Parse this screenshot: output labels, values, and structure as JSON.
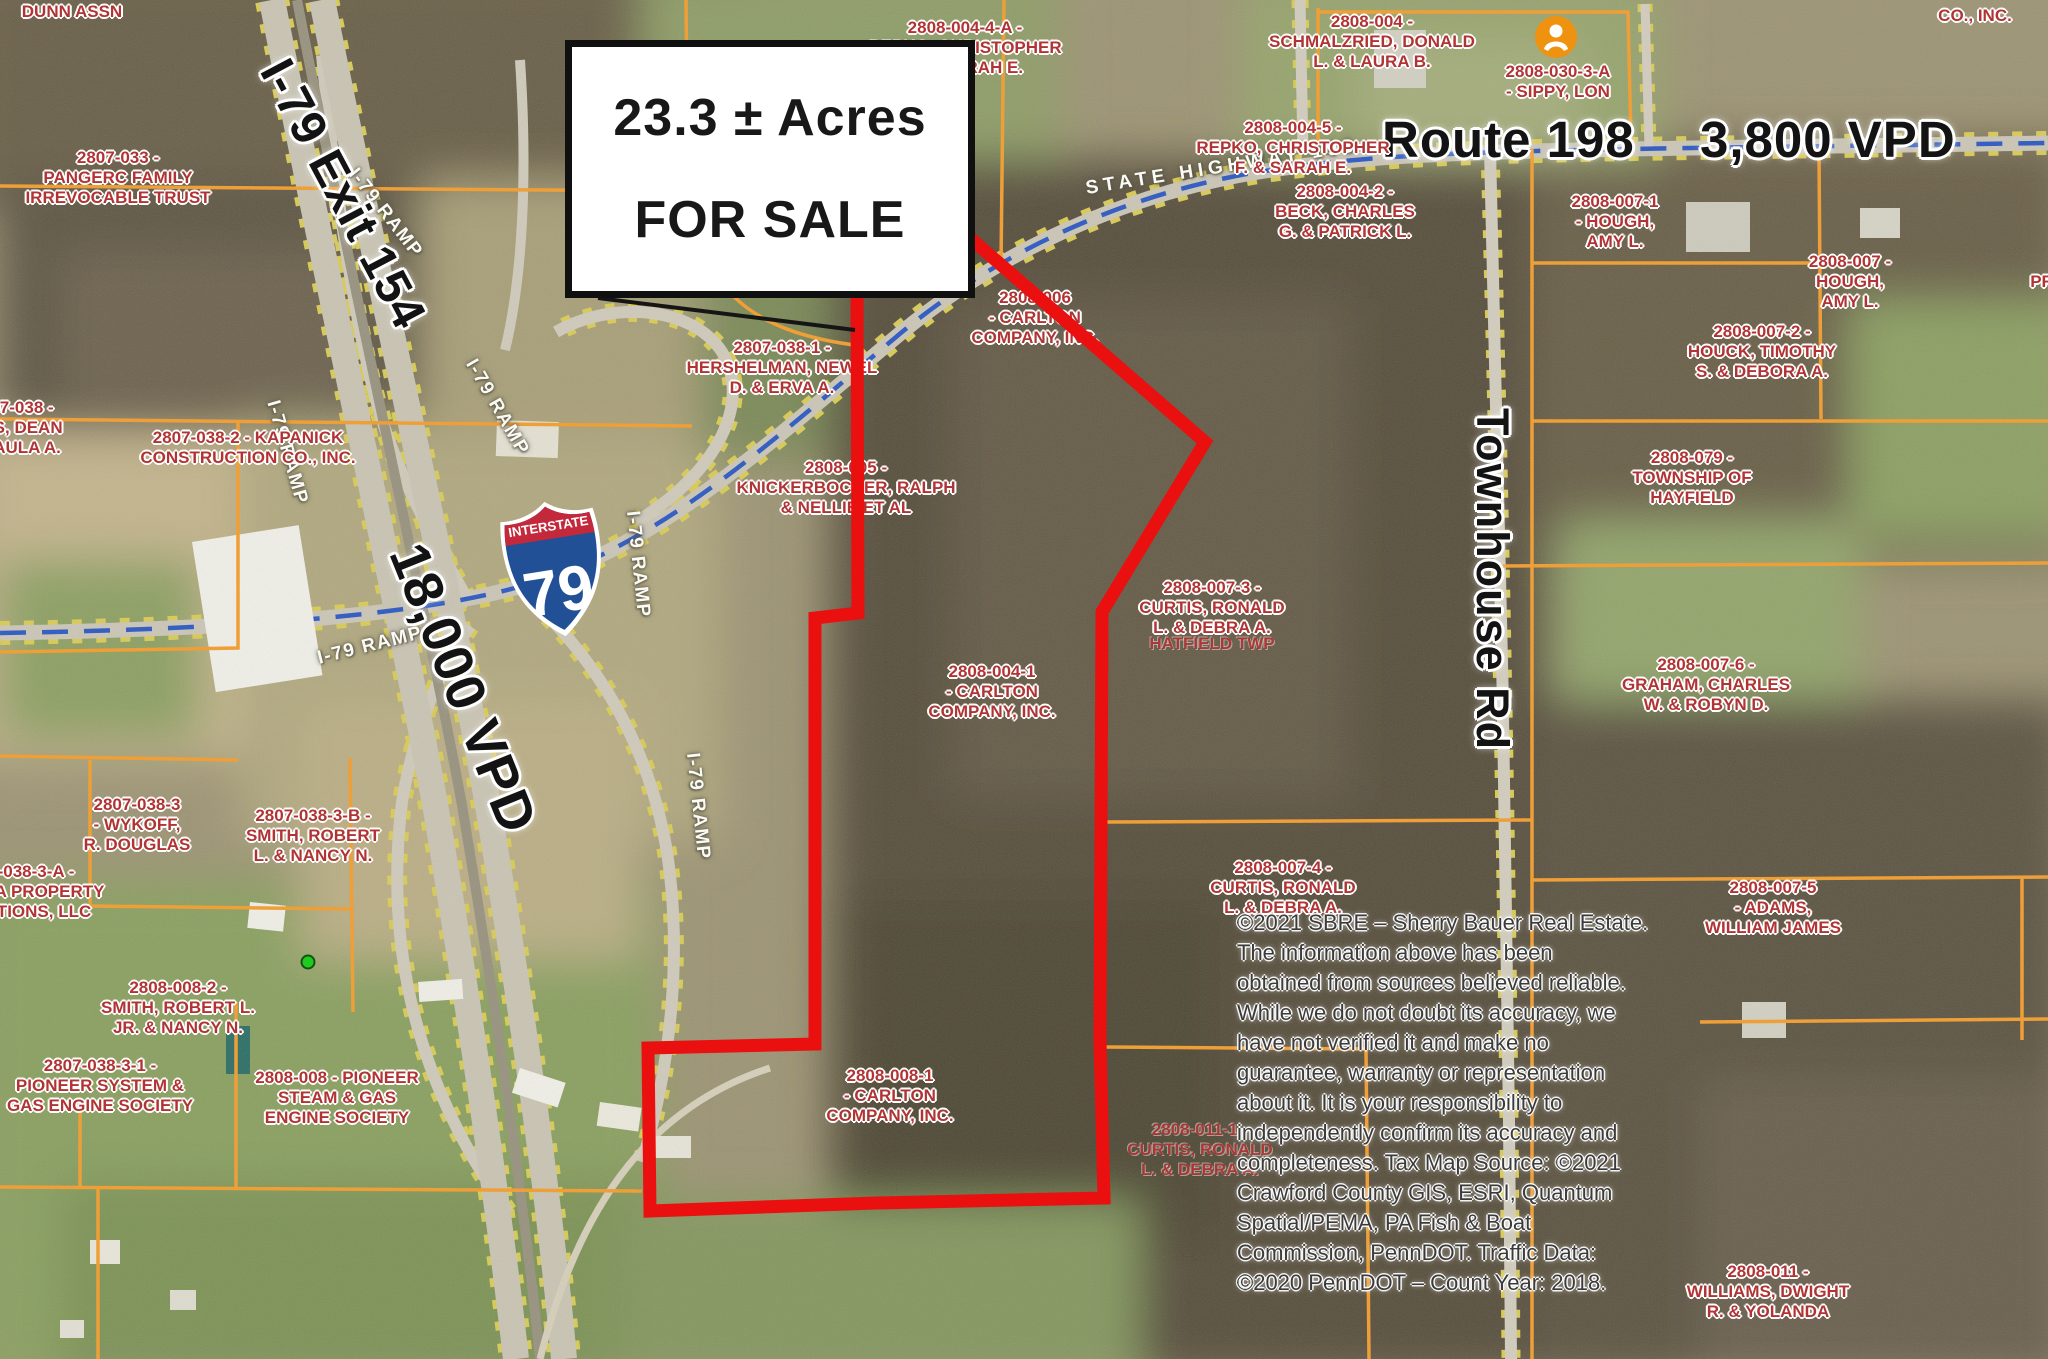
{
  "map_title": "Aerial tax-parcel map of 23.3 acre property at I-79 Exit 154 and Route 198",
  "sale_box": {
    "line1": "23.3 ± Acres",
    "line2": "FOR SALE"
  },
  "big_labels": {
    "i79_exit": "I-79  Exit 154",
    "i79_vpd": "18,000 VPD",
    "route": "Route 198",
    "route_vpd": "3,800 VPD",
    "townhouse_rd": "Townhouse Rd"
  },
  "shield": {
    "top": "INTERSTATE",
    "number": "79"
  },
  "colors": {
    "property_outline_red": "#ea1010",
    "parcel_line_orange": "#ef9f38",
    "parcel_label_red": "#b13434",
    "state_route_blue": "#2b59c3",
    "road_edge_yellow": "#d9cb55",
    "shield_blue": "#215097",
    "shield_red": "#c3293b",
    "poi_marker_orange": "#ef9210",
    "site_dot_green": "#1ecb1e"
  },
  "road_labels": [
    {
      "text": "I-79 RAMP",
      "x": 352,
      "y": 160,
      "rot": 52
    },
    {
      "text": "I-79 RAMP",
      "x": 272,
      "y": 390,
      "rot": 74
    },
    {
      "text": "I-79 RAMP",
      "x": 470,
      "y": 350,
      "rot": 60
    },
    {
      "text": "I-79 RAMP",
      "x": 318,
      "y": 648,
      "rot": -14
    },
    {
      "text": "I-79 RAMP",
      "x": 632,
      "y": 500,
      "rot": 84
    },
    {
      "text": "I-79 RAMP",
      "x": 692,
      "y": 742,
      "rot": 84
    },
    {
      "text": "STATE HIGHWAY 198",
      "x": 1086,
      "y": 178,
      "rot": -9,
      "ls": 5
    }
  ],
  "parcel_labels": [
    {
      "x": 72,
      "y": 2,
      "lines": [
        "DUNN ASSN"
      ]
    },
    {
      "x": 118,
      "y": 148,
      "lines": [
        "2807-033 -",
        "PANGERC FAMILY",
        "IRREVOCABLE TRUST"
      ]
    },
    {
      "x": 22,
      "y": 398,
      "lines": [
        "07-038 -",
        "AS, DEAN",
        "PAULA A."
      ]
    },
    {
      "x": 248,
      "y": 428,
      "lines": [
        "2807-038-2 - KAPANICK",
        "CONSTRUCTION CO., INC."
      ]
    },
    {
      "x": 782,
      "y": 338,
      "lines": [
        "2807-038-1 -",
        "HERSHELMAN, NEWEL",
        "D. & ERVA A."
      ]
    },
    {
      "x": 846,
      "y": 458,
      "lines": [
        "2808-005 -",
        "KNICKERBOCKER, RALPH",
        "& NELLIE ET AL"
      ]
    },
    {
      "x": 965,
      "y": 18,
      "lines": [
        "2808-004-4-A -",
        "REPKO, CHRISTOPHER",
        "F. & SARAH E."
      ]
    },
    {
      "x": 1372,
      "y": 12,
      "lines": [
        "2808-004 -",
        "SCHMALZRIED, DONALD",
        "L. & LAURA B."
      ]
    },
    {
      "x": 1293,
      "y": 118,
      "lines": [
        "2808-004-5 -",
        "REPKO, CHRISTOPHER",
        "F. & SARAH E."
      ]
    },
    {
      "x": 1558,
      "y": 62,
      "lines": [
        "2808-030-3-A",
        "- SIPPY, LON"
      ]
    },
    {
      "x": 1975,
      "y": 6,
      "lines": [
        "CO., INC."
      ]
    },
    {
      "x": 1035,
      "y": 288,
      "lines": [
        "2808-006",
        "- CARLTON",
        "COMPANY, INC."
      ]
    },
    {
      "x": 1345,
      "y": 182,
      "lines": [
        "2808-004-2 -",
        "BECK, CHARLES",
        "G. & PATRICK L."
      ]
    },
    {
      "x": 1615,
      "y": 192,
      "lines": [
        "2808-007-1",
        "- HOUGH,",
        "AMY L."
      ]
    },
    {
      "x": 1850,
      "y": 252,
      "lines": [
        "2808-007 -",
        "HOUGH,",
        "AMY L."
      ]
    },
    {
      "x": 1762,
      "y": 322,
      "lines": [
        "2808-007-2 -",
        "HOUCK, TIMOTHY",
        "S. & DEBORA A."
      ]
    },
    {
      "x": 2042,
      "y": 272,
      "lines": [
        "PR"
      ]
    },
    {
      "x": 1692,
      "y": 448,
      "lines": [
        "2808-079 -",
        "TOWNSHIP OF",
        "HAYFIELD"
      ]
    },
    {
      "x": 1212,
      "y": 578,
      "lines": [
        "2808-007-3 -",
        "CURTIS, RONALD",
        "L. & DEBRA A."
      ]
    },
    {
      "x": 1212,
      "y": 634,
      "dim": true,
      "lines": [
        "HATFIELD TWP"
      ]
    },
    {
      "x": 1706,
      "y": 655,
      "lines": [
        "2808-007-6 -",
        "GRAHAM, CHARLES",
        "W. & ROBYN D."
      ]
    },
    {
      "x": 992,
      "y": 662,
      "lines": [
        "2808-004-1",
        "- CARLTON",
        "COMPANY, INC."
      ]
    },
    {
      "x": 1283,
      "y": 858,
      "lines": [
        "2808-007-4 -",
        "CURTIS, RONALD",
        "L. & DEBRA A."
      ]
    },
    {
      "x": 1773,
      "y": 878,
      "lines": [
        "2808-007-5",
        "- ADAMS,",
        "WILLIAM JAMES"
      ]
    },
    {
      "x": 137,
      "y": 795,
      "lines": [
        "2807-038-3",
        "- WYKOFF,",
        "R. DOUGLAS"
      ]
    },
    {
      "x": 313,
      "y": 806,
      "lines": [
        "2807-038-3-B -",
        "SMITH, ROBERT",
        "L. & NANCY N."
      ]
    },
    {
      "x": 36,
      "y": 862,
      "lines": [
        "-038-3-A -",
        "N PA PROPERTY",
        "SITIONS, LLC"
      ]
    },
    {
      "x": 178,
      "y": 978,
      "lines": [
        "2808-008-2 -",
        "SMITH, ROBERT L.",
        "JR. & NANCY N."
      ]
    },
    {
      "x": 100,
      "y": 1056,
      "lines": [
        "2807-038-3-1 -",
        "PIONEER SYSTEM &",
        "GAS ENGINE SOCIETY"
      ]
    },
    {
      "x": 337,
      "y": 1068,
      "lines": [
        "2808-008 - PIONEER",
        "STEAM & GAS",
        "ENGINE SOCIETY"
      ]
    },
    {
      "x": 890,
      "y": 1066,
      "lines": [
        "2808-008-1",
        "- CARLTON",
        "COMPANY, INC."
      ]
    },
    {
      "x": 1200,
      "y": 1120,
      "dim": true,
      "lines": [
        "2808-011-1 -",
        "CURTIS, RONALD",
        "L. & DEBRA A."
      ]
    },
    {
      "x": 1768,
      "y": 1262,
      "lines": [
        "2808-011 -",
        "WILLIAMS, DWIGHT",
        "R. & YOLANDA"
      ]
    }
  ],
  "disclaimer": {
    "lines": [
      "©2021 SBRE – Sherry Bauer Real Estate.",
      "The information above has been",
      "obtained from sources believed reliable.",
      "While we do not doubt its accuracy, we",
      "have not verified it and make no",
      "guarantee, warranty or representation",
      "about it. It is your responsibility to",
      "independently confirm its accuracy and",
      "completeness.   Tax Map Source: ©2021",
      "Crawford County GIS, ESRI, Quantum",
      "Spatial/PEMA, PA Fish & Boat",
      "Commission, PennDOT. Traffic Data:",
      "©2020 PennDOT – Count Year: 2018."
    ]
  }
}
